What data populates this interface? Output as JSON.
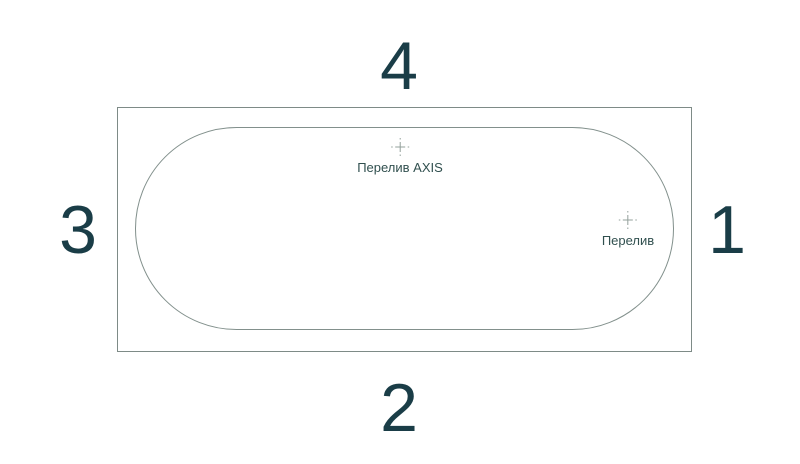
{
  "diagram": {
    "title": "bathtub-top-view",
    "side_labels": {
      "top": "4",
      "right": "1",
      "bottom": "2",
      "left": "3"
    },
    "markers": [
      {
        "id": "overflow-axis",
        "label": "Перелив AXIS"
      },
      {
        "id": "overflow",
        "label": "Перелив"
      }
    ],
    "colors": {
      "background": "#ffffff",
      "outline": "#7e8b87",
      "number": "#1a3d47",
      "label": "#31504f",
      "crosshair": "#93a09b"
    }
  }
}
